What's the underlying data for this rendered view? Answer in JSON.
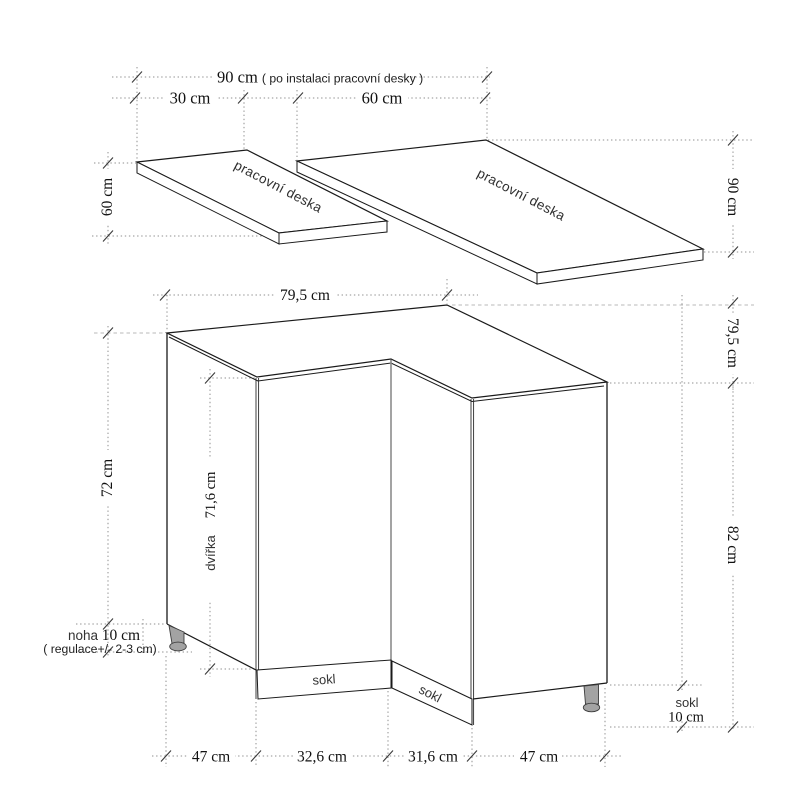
{
  "figure": {
    "background": "#ffffff",
    "line_color": "#1a1a1a",
    "dotted_color": "#8f8f8f",
    "leg_color": "#a3a3a3"
  },
  "worktops": {
    "left_label": "pracovní deska",
    "right_label": "pracovní deska"
  },
  "plinths": {
    "left": "sokl",
    "mid": "sokl"
  },
  "dims": {
    "total_width": "90 cm ",
    "total_width_note": "( po instalaci pracovní desky )",
    "left_width": "30 cm",
    "right_width": "60 cm",
    "left_depth": "60 cm",
    "right_depth": "90 cm",
    "cab_width": "79,5 cm",
    "cab_depth": "79,5 cm",
    "body_height": "72 cm",
    "door_label": "dvířka",
    "door_value": "71,6 cm",
    "total_height": "82 cm",
    "leg_label": "noha ",
    "leg_value": "10 cm",
    "leg_note": "( regulace+/- 2-3 cm)",
    "plinth_right_label": "sokl",
    "plinth_right_value": "10 cm",
    "bottom": [
      "47 cm",
      "32,6 cm",
      "31,6 cm",
      "47 cm"
    ]
  }
}
